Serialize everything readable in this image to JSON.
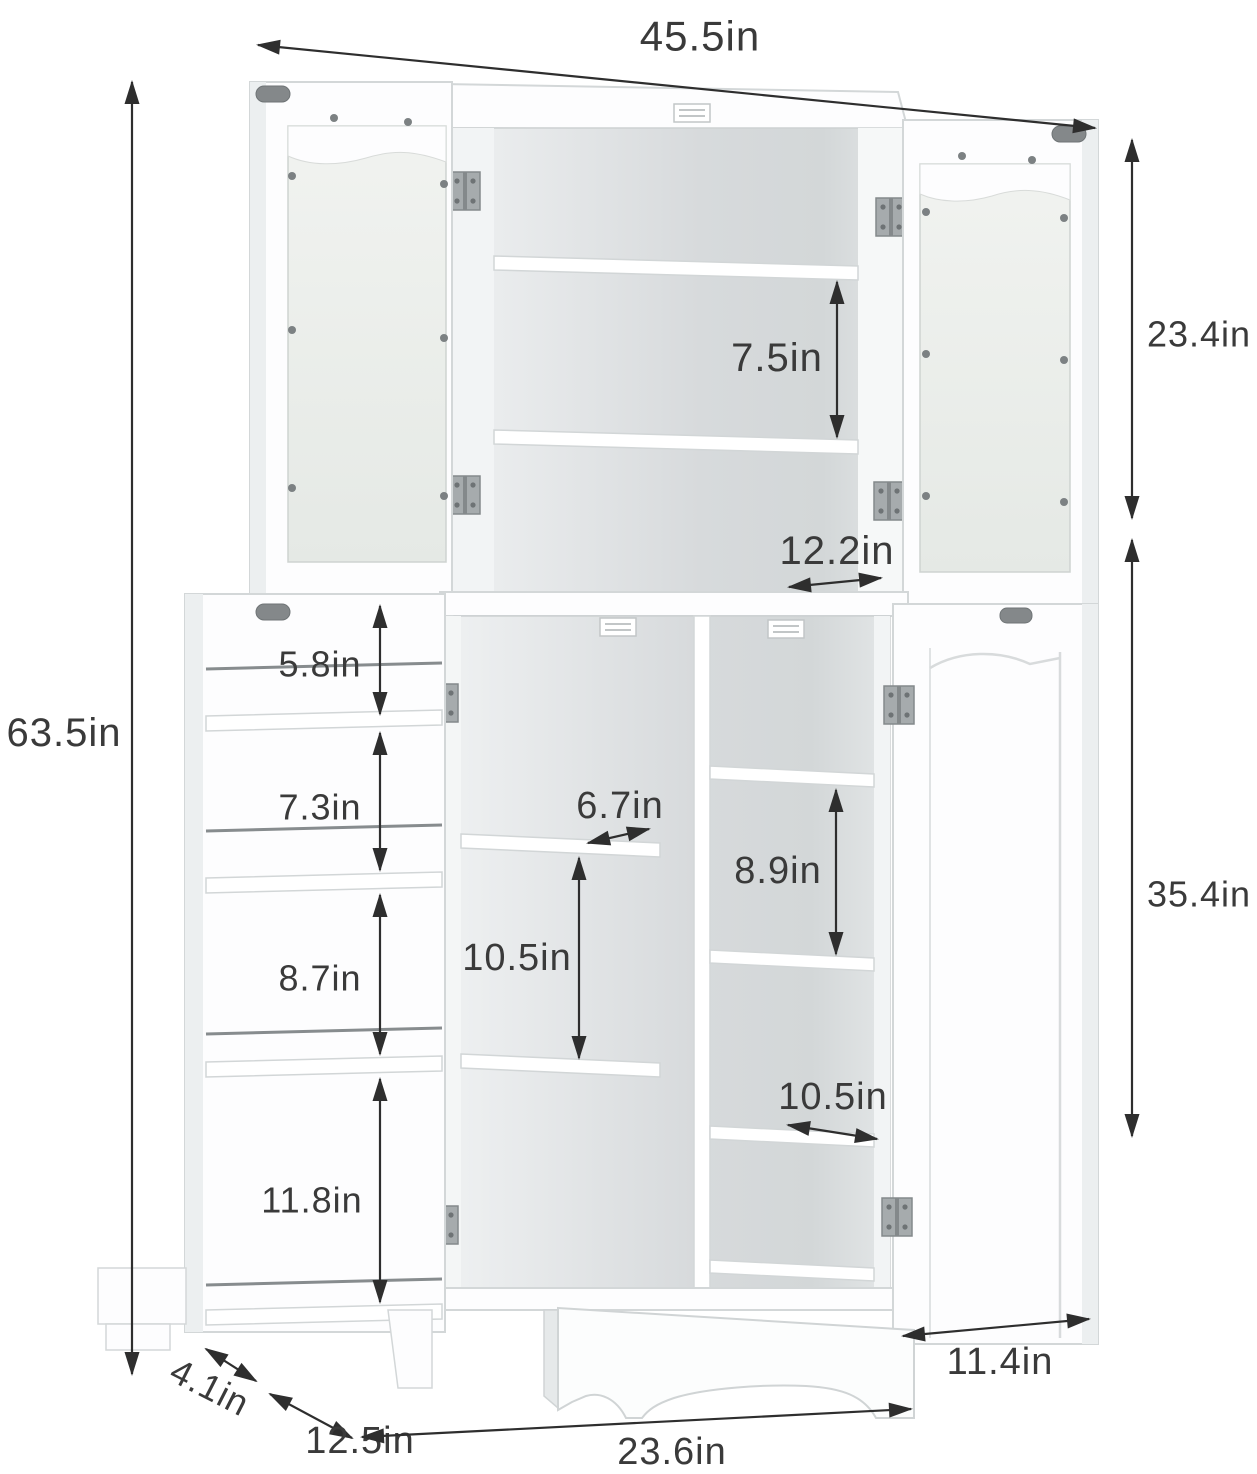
{
  "diagram": {
    "unit": "in",
    "labels": {
      "overall_width": "45.5in",
      "overall_height": "63.5in",
      "upper_cabinet_height": "23.4in",
      "lower_cabinet_height": "35.4in",
      "upper_shelf_spacing": "7.5in",
      "upper_cabinet_depth": "12.2in",
      "door_rack_spacing_1": "5.8in",
      "door_rack_spacing_2": "7.3in",
      "door_rack_spacing_3": "8.7in",
      "door_rack_spacing_4": "11.8in",
      "center_shelf_depth": "6.7in",
      "center_shelf_spacing": "10.5in",
      "right_shelf_spacing": "8.9in",
      "right_shelf_depth": "10.5in",
      "right_door_width": "11.4in",
      "door_rack_depth": "4.1in",
      "side_base_depth": "12.5in",
      "base_width": "23.6in"
    },
    "colors": {
      "annotation": "#2e2e2e",
      "cabinet_fill": "#fdfdfe",
      "cabinet_outline": "#d3d7d8"
    }
  }
}
